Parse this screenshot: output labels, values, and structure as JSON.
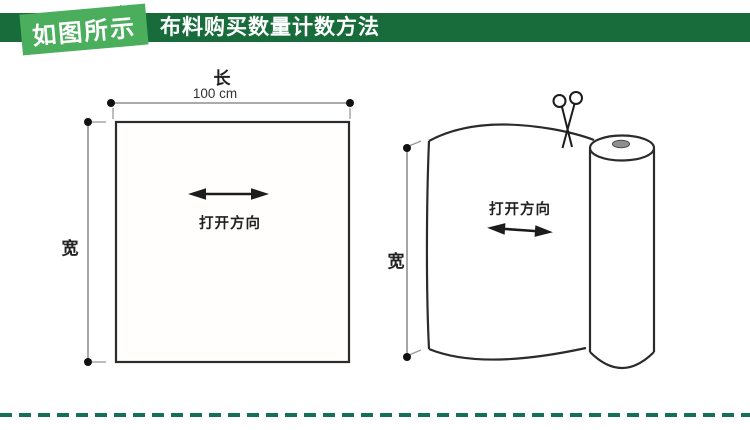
{
  "header": {
    "badge_label": "如图所示",
    "title": "布料购买数量计数方法",
    "colors": {
      "bar": "#186c3b",
      "ribbon": "#4aae5d",
      "ribbon_fold": "#2e7d43",
      "text": "#ffffff"
    }
  },
  "diagram_left": {
    "length_label": "长",
    "length_value": "100 cm",
    "width_label": "宽",
    "direction_label": "打开方向"
  },
  "diagram_right": {
    "width_label": "宽",
    "direction_label": "打开方向",
    "scissors_icon": "✂"
  },
  "footer": {
    "dash_color": "#15705a"
  }
}
